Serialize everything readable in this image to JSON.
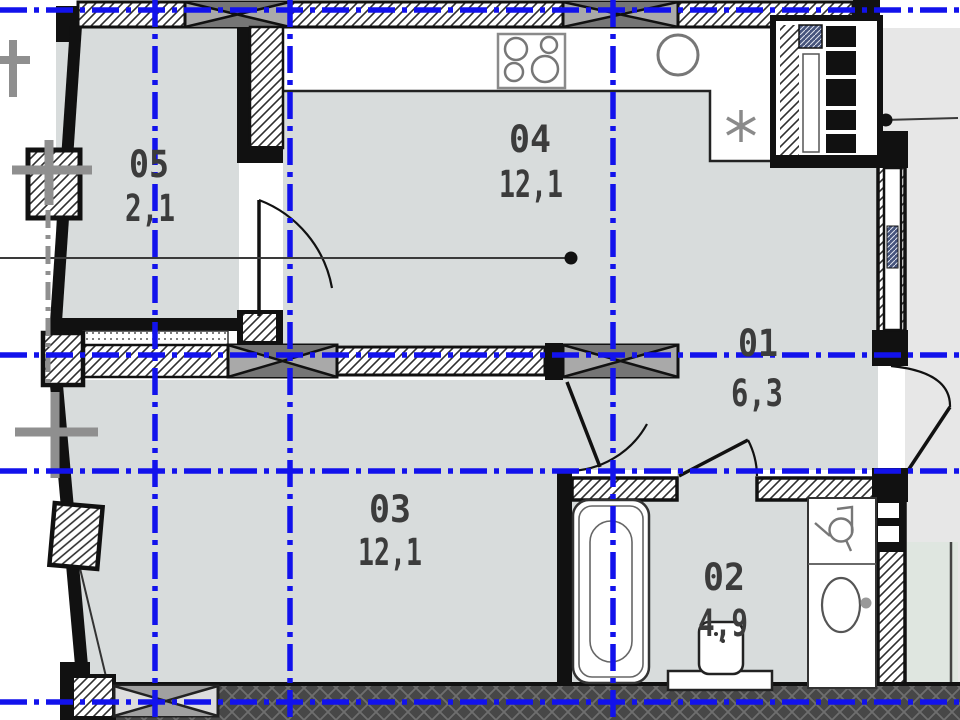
{
  "plan": {
    "title": "apartment-floor-plan",
    "rooms": [
      {
        "number": "05",
        "area": "2,1"
      },
      {
        "number": "04",
        "area": "12,1"
      },
      {
        "number": "01",
        "area": "6,3"
      },
      {
        "number": "03",
        "area": "12,1"
      },
      {
        "number": "02",
        "area": "4,9"
      }
    ],
    "colors": {
      "axis_blue": "#1212ec",
      "floor_fill": "#d8dcdc",
      "wall_black": "#111111",
      "neighbor_gray": "#8f8f8f",
      "outside_right": "#e7e7e7",
      "balcony_tint": "#dfe6e0",
      "label_text": "#3c3c3c"
    },
    "fixtures": [
      "stove-icon",
      "kitchen-sink-icon",
      "fridge-asterisk-icon",
      "bathtub-icon",
      "toilet-icon",
      "washing-machine-icon",
      "washbasin-icon",
      "ventilation-shaft"
    ]
  }
}
